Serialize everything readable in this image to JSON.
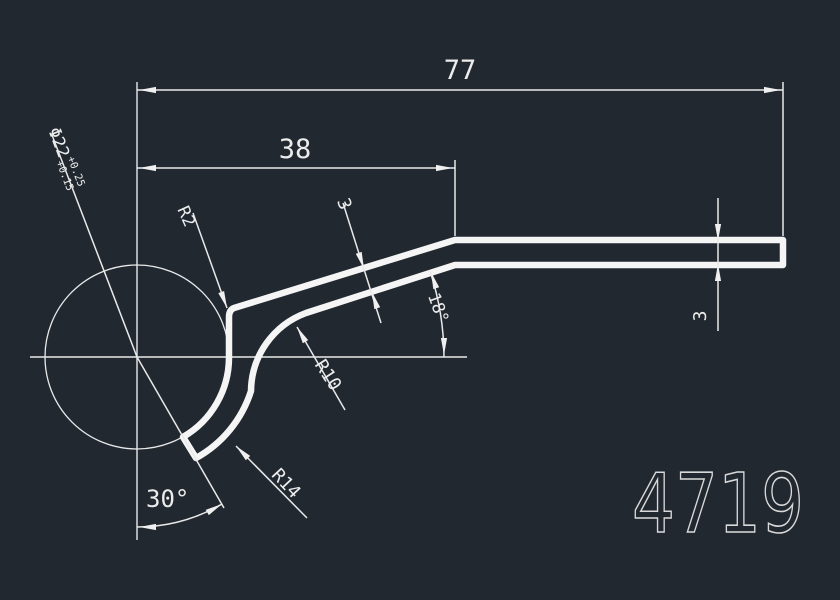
{
  "drawing": {
    "background": "#212830",
    "line_color": "#efefef",
    "text_color": "#ececec",
    "part_number": "4719",
    "dimensions": {
      "length_total": "77",
      "length_upper": "38",
      "diameter": "Φ22",
      "diameter_tol_upper": "+0.25",
      "diameter_tol_lower": "+0.15",
      "radius_corner": "R2",
      "radius_inner_bend": "R10",
      "radius_outer_wrap": "R14",
      "thickness_mid": "3",
      "thickness_right": "3",
      "angle_slope": "18°",
      "angle_end": "30°"
    }
  }
}
